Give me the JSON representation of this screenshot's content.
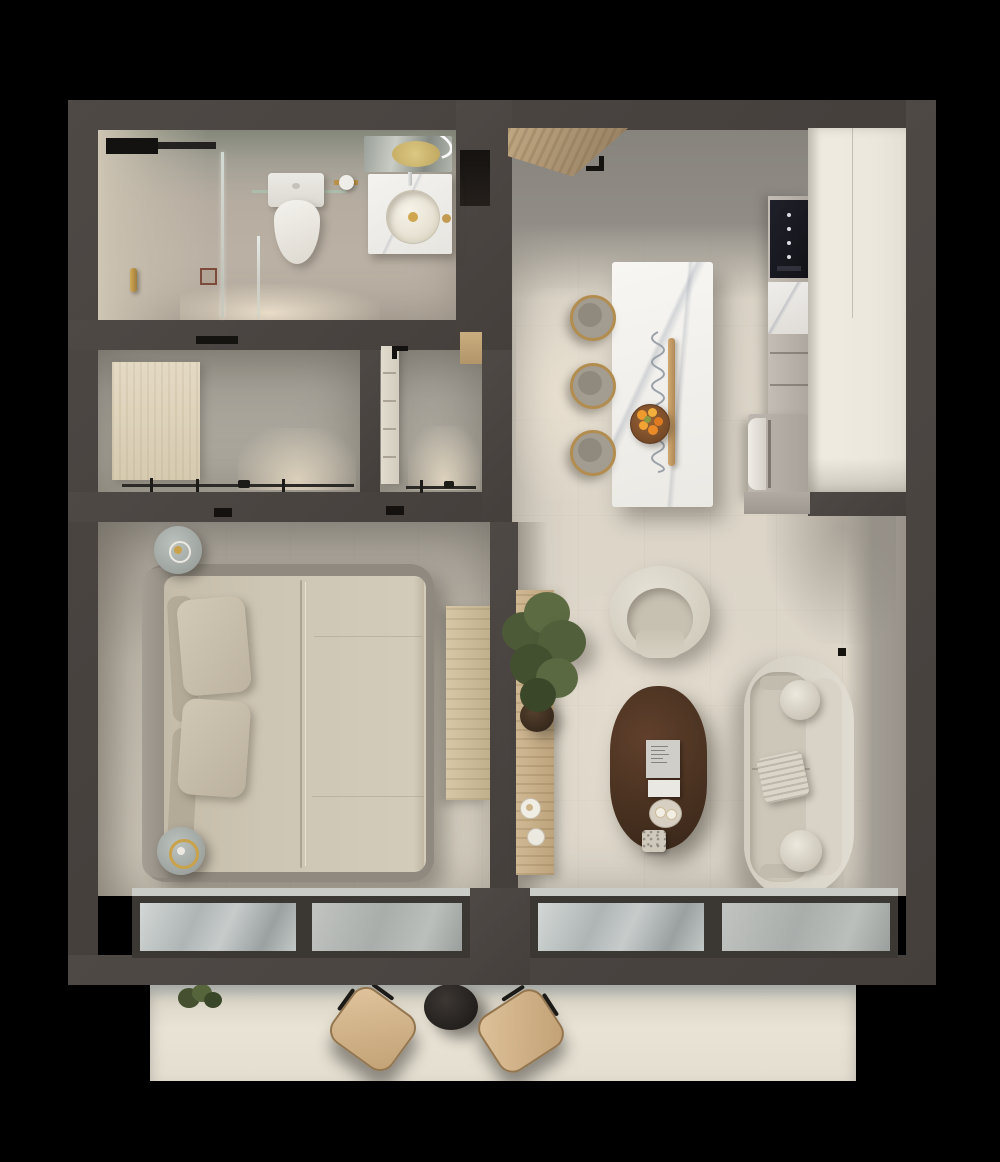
{
  "scene": {
    "type": "3d-floor-plan-render",
    "view": "top-down",
    "unit": "one-bedroom apartment with balcony"
  },
  "palette": {
    "background": "#000000",
    "wall": "#4a4441",
    "floor_warm": "#dcd5c8",
    "floor_gray": "#928e87",
    "marble": "#f3f2ef",
    "wood": "#c9b28e",
    "cream_furniture": "#dcd7cb",
    "coffee_table_brown": "#4a3124",
    "plant_green": "#57643f",
    "gold_brass": "#c29a52",
    "fruit_orange": "#e98a2b",
    "window_frame": "#3b3733",
    "balcony_chair_tan": "#d3b58c"
  },
  "rooms": [
    {
      "id": "bathroom",
      "label": "Bathroom",
      "items": [
        "walk-in-shower",
        "glass-partition",
        "toilet",
        "toilet-paper-holder",
        "vanity",
        "round-vessel-sink",
        "led-mirror",
        "floor-drain",
        "brass-door-handle",
        "ceiling-vent"
      ]
    },
    {
      "id": "closet-a",
      "label": "Wardrobe closet",
      "items": [
        "wood-wardrobe-panel",
        "hanging-rail",
        "hangers",
        "ceiling-light-track"
      ]
    },
    {
      "id": "closet-b",
      "label": "Hall closet",
      "items": [
        "drawer-unit",
        "hanging-rail",
        "hangers",
        "door-hinge-mark"
      ]
    },
    {
      "id": "entry",
      "label": "Entry hall",
      "items": [
        "open-wooden-front-door",
        "black-door-handle",
        "gray-tile-floor"
      ]
    },
    {
      "id": "kitchen",
      "label": "Kitchen and dining",
      "items": [
        "marble-island",
        "bar-stools",
        "fruit-bowl",
        "pendant-rail-light",
        "built-in-oven",
        "marble-backsplash",
        "appliance",
        "tall-pantry-cabinet",
        "counter"
      ]
    },
    {
      "id": "bedroom",
      "label": "Bedroom",
      "items": [
        "double-bed",
        "pillows",
        "round-nightstand-lamps",
        "wood-bench",
        "sliding-window"
      ]
    },
    {
      "id": "living",
      "label": "Living room",
      "items": [
        "curved-armchair",
        "curved-sofa",
        "bolster-pillows",
        "textured-pillow",
        "oval-coffee-table",
        "book-stack",
        "serving-tray",
        "potted-tree",
        "wood-sideboard",
        "cups",
        "sliding-window"
      ]
    },
    {
      "id": "balcony",
      "label": "Balcony",
      "items": [
        "lounge-chairs",
        "round-side-table",
        "small-plant"
      ]
    }
  ],
  "counts": {
    "bar_stools": 3,
    "bed_pillows": 4,
    "sofa_bolsters": 2,
    "balcony_chairs": 2,
    "windows": 2,
    "closets": 2
  }
}
